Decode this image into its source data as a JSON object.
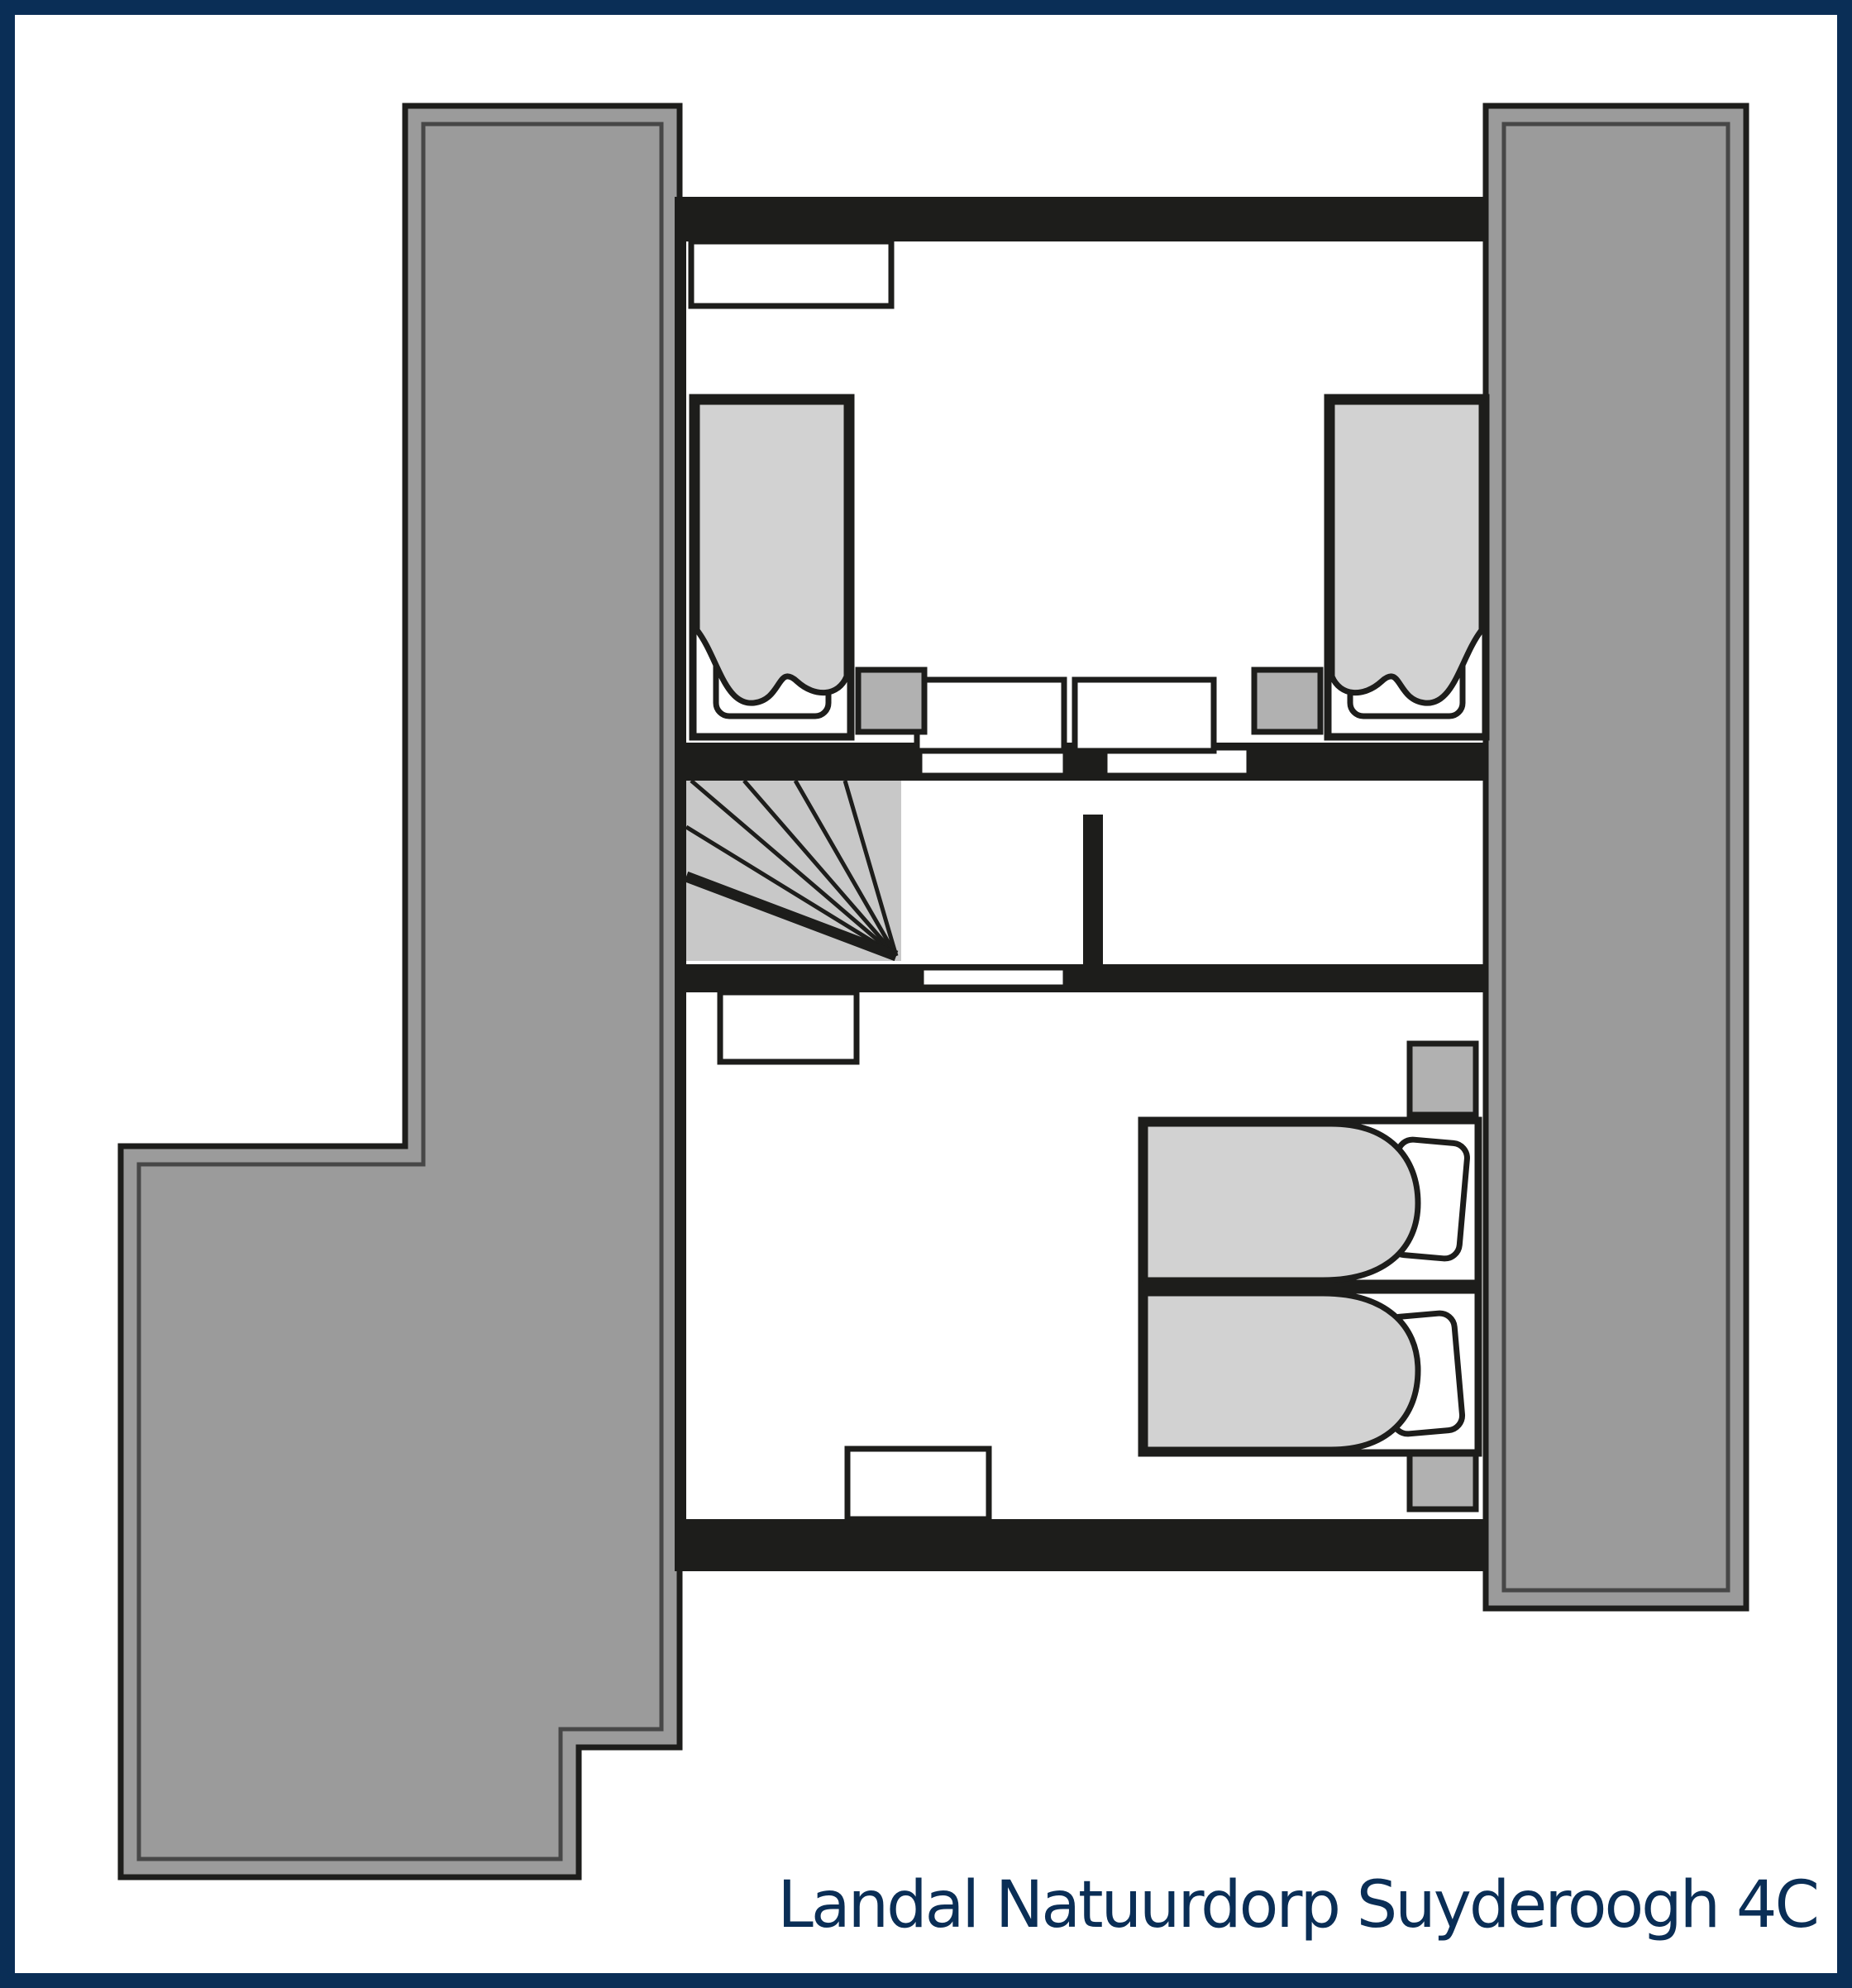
{
  "caption": {
    "text": "Landal Natuurdorp Suyderoogh 4C"
  },
  "colors": {
    "navy": "#0a2e56",
    "wall": "#1d1d1b",
    "roof": "#9b9b9b",
    "roofline": "#474747",
    "stair": "#c8c8c8",
    "duvet": "#d2d2d2",
    "stand": "#b1b1b1"
  }
}
